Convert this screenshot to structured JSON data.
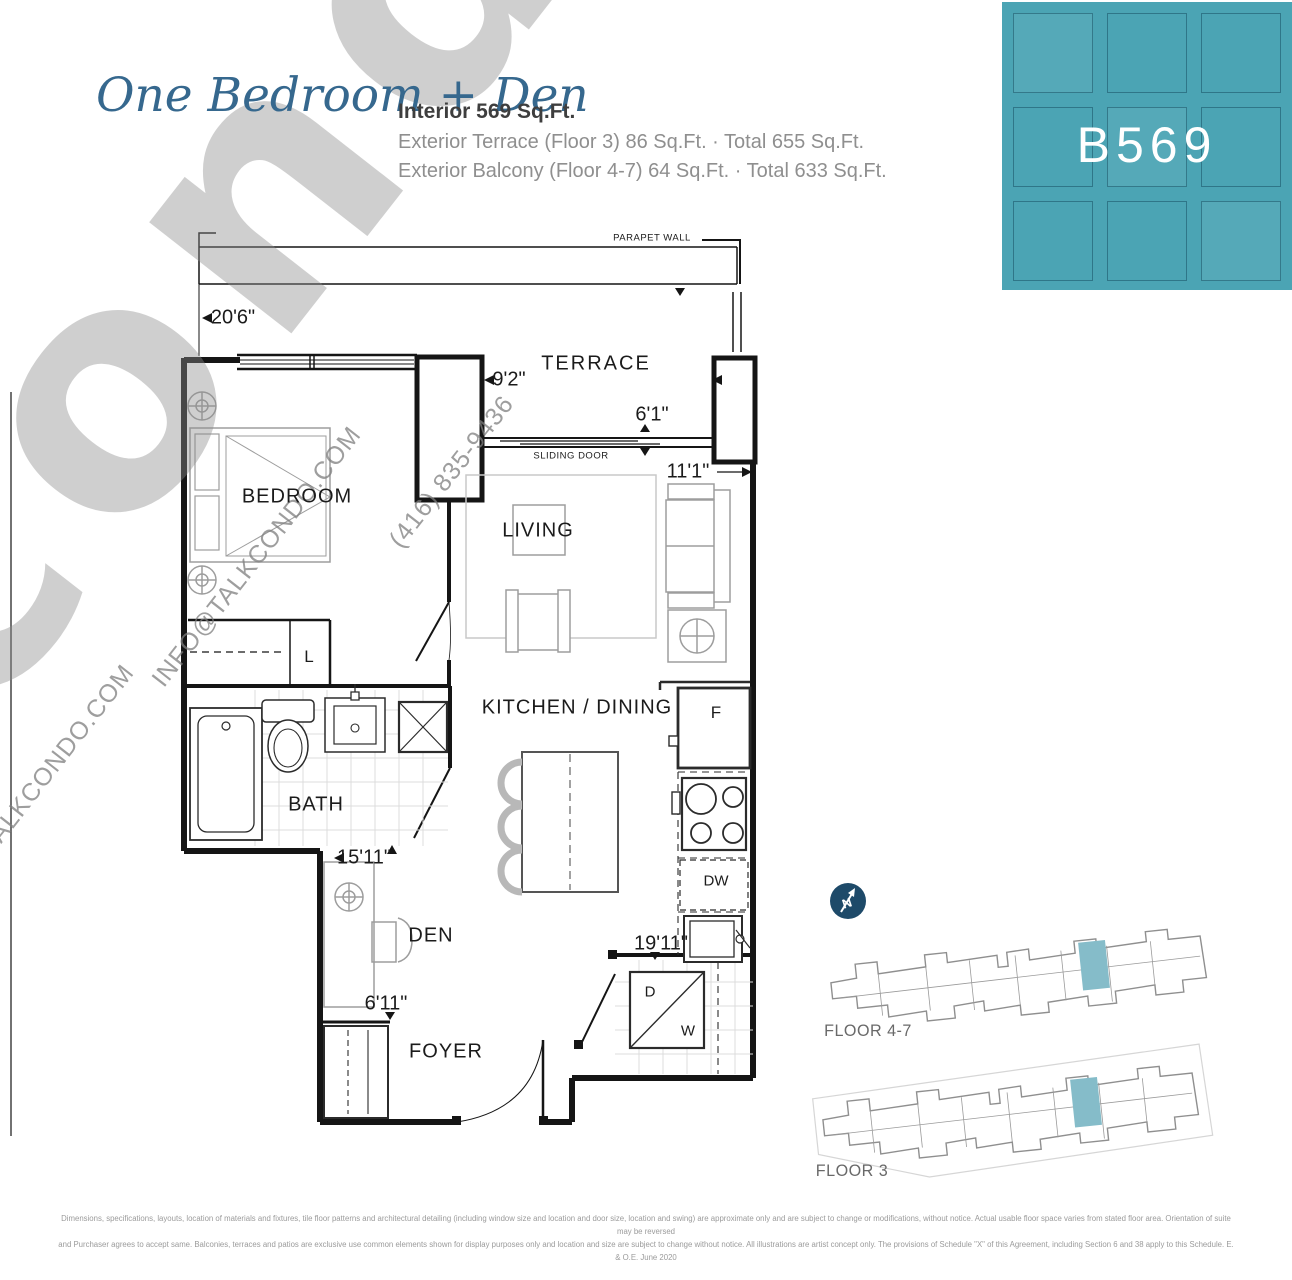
{
  "header": {
    "plan_name": "One Bedroom + Den",
    "interior": "Interior 569 Sq.Ft.",
    "line2": "Exterior Terrace (Floor 3) 86 Sq.Ft. · Total 655 Sq.Ft.",
    "line3": "Exterior Balcony (Floor 4-7) 64 Sq.Ft. · Total 633 Sq.Ft.",
    "unit_code": "B569"
  },
  "colors": {
    "teal_block": "#4BA4B4",
    "unit_highlight": "#85BCC9",
    "north_circle": "#1E4A69",
    "script_blue": "#36688E"
  },
  "plan_labels": {
    "parapet_wall": "PARAPET WALL",
    "terrace": "TERRACE",
    "sliding_door": "SLIDING DOOR",
    "bedroom": "BEDROOM",
    "living": "LIVING",
    "kitchen_dining": "KITCHEN / DINING",
    "bath": "BATH",
    "den": "DEN",
    "foyer": "FOYER",
    "linen_closet": "L",
    "fridge": "F",
    "dishwasher": "DW",
    "dryer": "D",
    "washer": "W"
  },
  "dimensions": {
    "terrace_width": "20'6\"",
    "bedroom_wall": "9'2\"",
    "sliding_door_width": "6'1\"",
    "living_width": "11'1\"",
    "unit_width": "15'11\"",
    "den_width": "6'11\"",
    "unit_depth": "19'11\""
  },
  "key_plans": {
    "floor47_label": "FLOOR 4-7",
    "floor3_label": "FLOOR 3",
    "north_label": "N"
  },
  "watermarks": {
    "big": "condo",
    "phone": "(416) 835-9436",
    "email": "INFO@TALKCONDO.COM",
    "email2": "INFO@TALKCONDO.COM"
  },
  "disclaimer": {
    "line1": "Dimensions, specifications, layouts, location of materials and fixtures, tile floor patterns and architectural detailing (including window size and location and door size, location and swing) are approximate only and are subject to change or modifications, without notice. Actual usable floor space varies from stated floor area. Orientation of suite may be reversed",
    "line2": "and Purchaser agrees to accept same. Balconies, terraces and patios are exclusive use common elements shown for display purposes only and location and size are subject to change without notice. All illustrations are artist concept only. The provisions of Schedule \"X\" of this Agreement, including Section 6 and 38 apply to this Schedule. E. & O.E. June 2020"
  }
}
